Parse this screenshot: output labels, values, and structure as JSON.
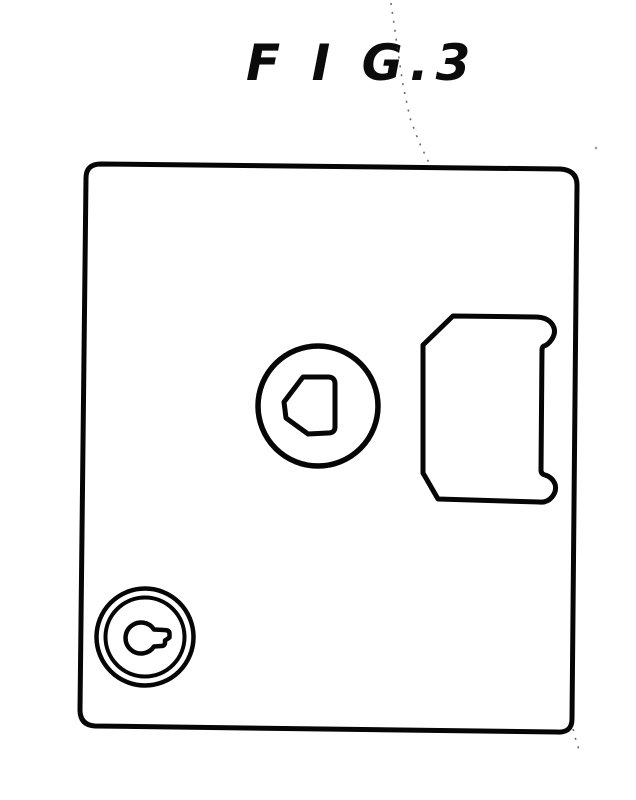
{
  "page": {
    "background": "#ffffff"
  },
  "figure": {
    "label": "F I G.3",
    "line_color": "#060606",
    "artifact_color": "#3a3a3a",
    "parts": {
      "plate": "mounting-plate-outline",
      "cam": "circular-cam-with-keyway",
      "keyway": "chamfered-d-keyway",
      "latch_tab": "latch-tab-with-rounded-ears",
      "cylinder": "key-cylinder-concentric-rings",
      "keyhole": "keyhole-with-side-notch",
      "artifact": "scanner-streak"
    }
  }
}
